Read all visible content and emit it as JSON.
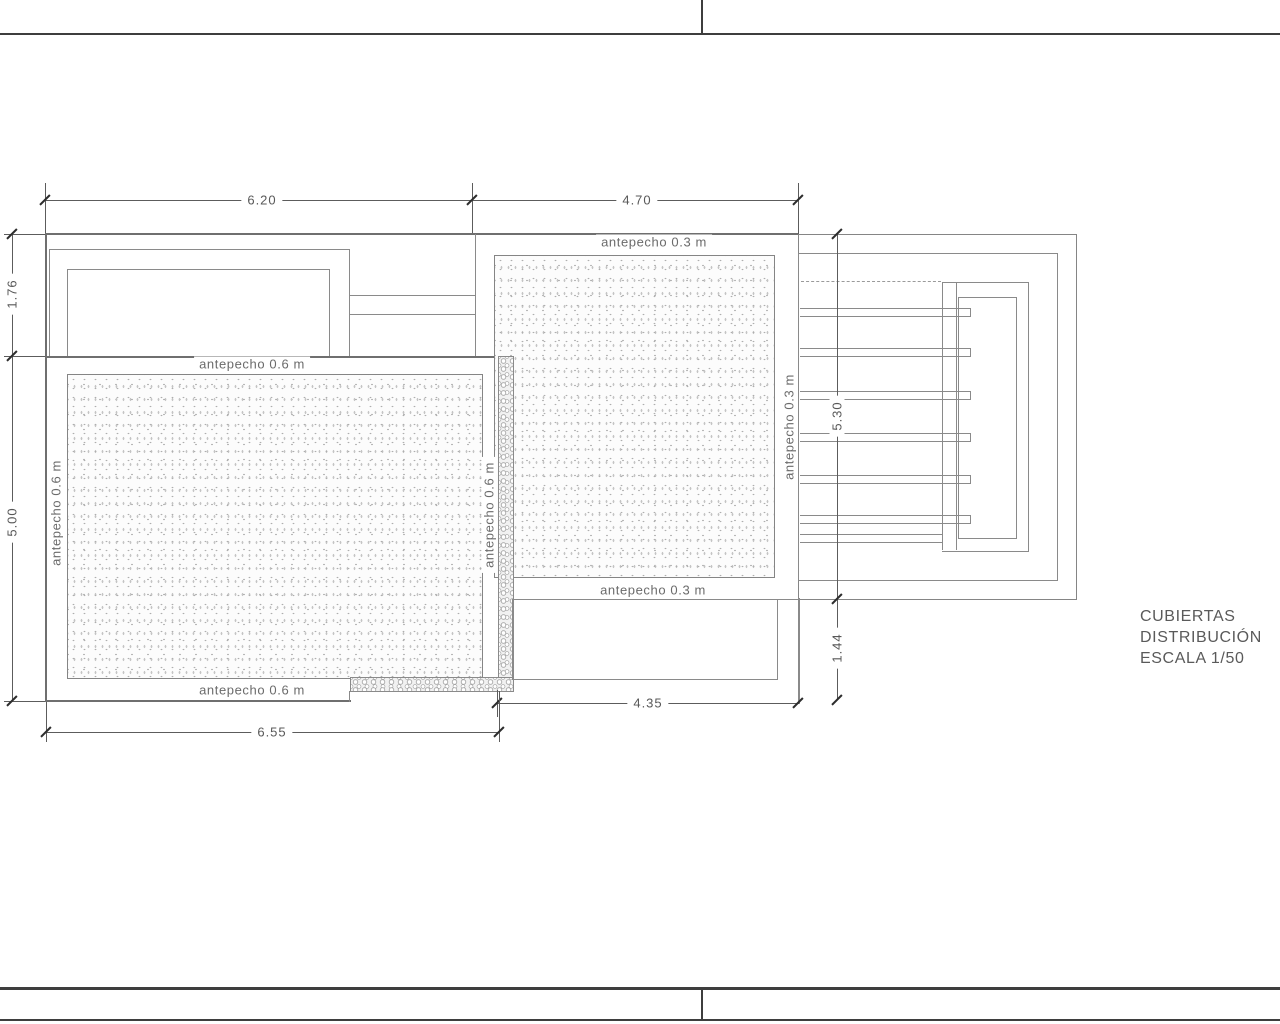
{
  "title_block": {
    "line1": "CUBIERTAS",
    "line2": "DISTRIBUCIÓN",
    "line3": "ESCALA 1/50"
  },
  "dimensions": {
    "top_left_width": "6.20",
    "top_right_width": "4.70",
    "left_upper_height": "1.76",
    "left_lower_height": "5.00",
    "right_upper_height": "5.30",
    "right_lower_height": "1.44",
    "bottom_inner_width": "4.35",
    "bottom_outer_width": "6.55"
  },
  "labels": {
    "parapet_main_top": "antepecho 0.6 m",
    "parapet_main_bottom": "antepecho 0.6 m",
    "parapet_main_left": "antepecho 0.6 m",
    "parapet_main_right": "antepecho 0.6 m",
    "parapet_terrace_top": "antepecho 0.3 m",
    "parapet_terrace_bottom": "antepecho 0.3 m",
    "parapet_terrace_right": "antepecho 0.3 m"
  },
  "colors": {
    "drawing_line": "#8a8a8a",
    "frame_line": "#3e3e3e",
    "text": "#5e5e5e"
  }
}
